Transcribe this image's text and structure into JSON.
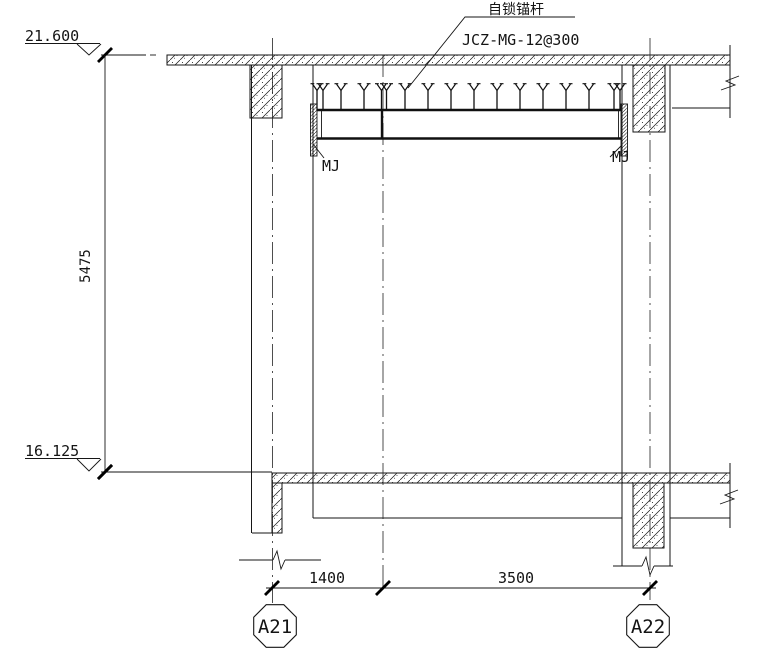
{
  "callouts": {
    "anchor_name": "自锁锚杆",
    "anchor_spec": "JCZ-MG-12@300",
    "embed_plate_left": "MJ",
    "embed_plate_right": "MJ"
  },
  "elevations": {
    "top": "21.600",
    "bottom": "16.125"
  },
  "dimensions": {
    "height": "5475",
    "bay_left": "1400",
    "bay_right": "3500"
  },
  "grid": {
    "left_bubble": "A21",
    "right_bubble": "A22"
  }
}
